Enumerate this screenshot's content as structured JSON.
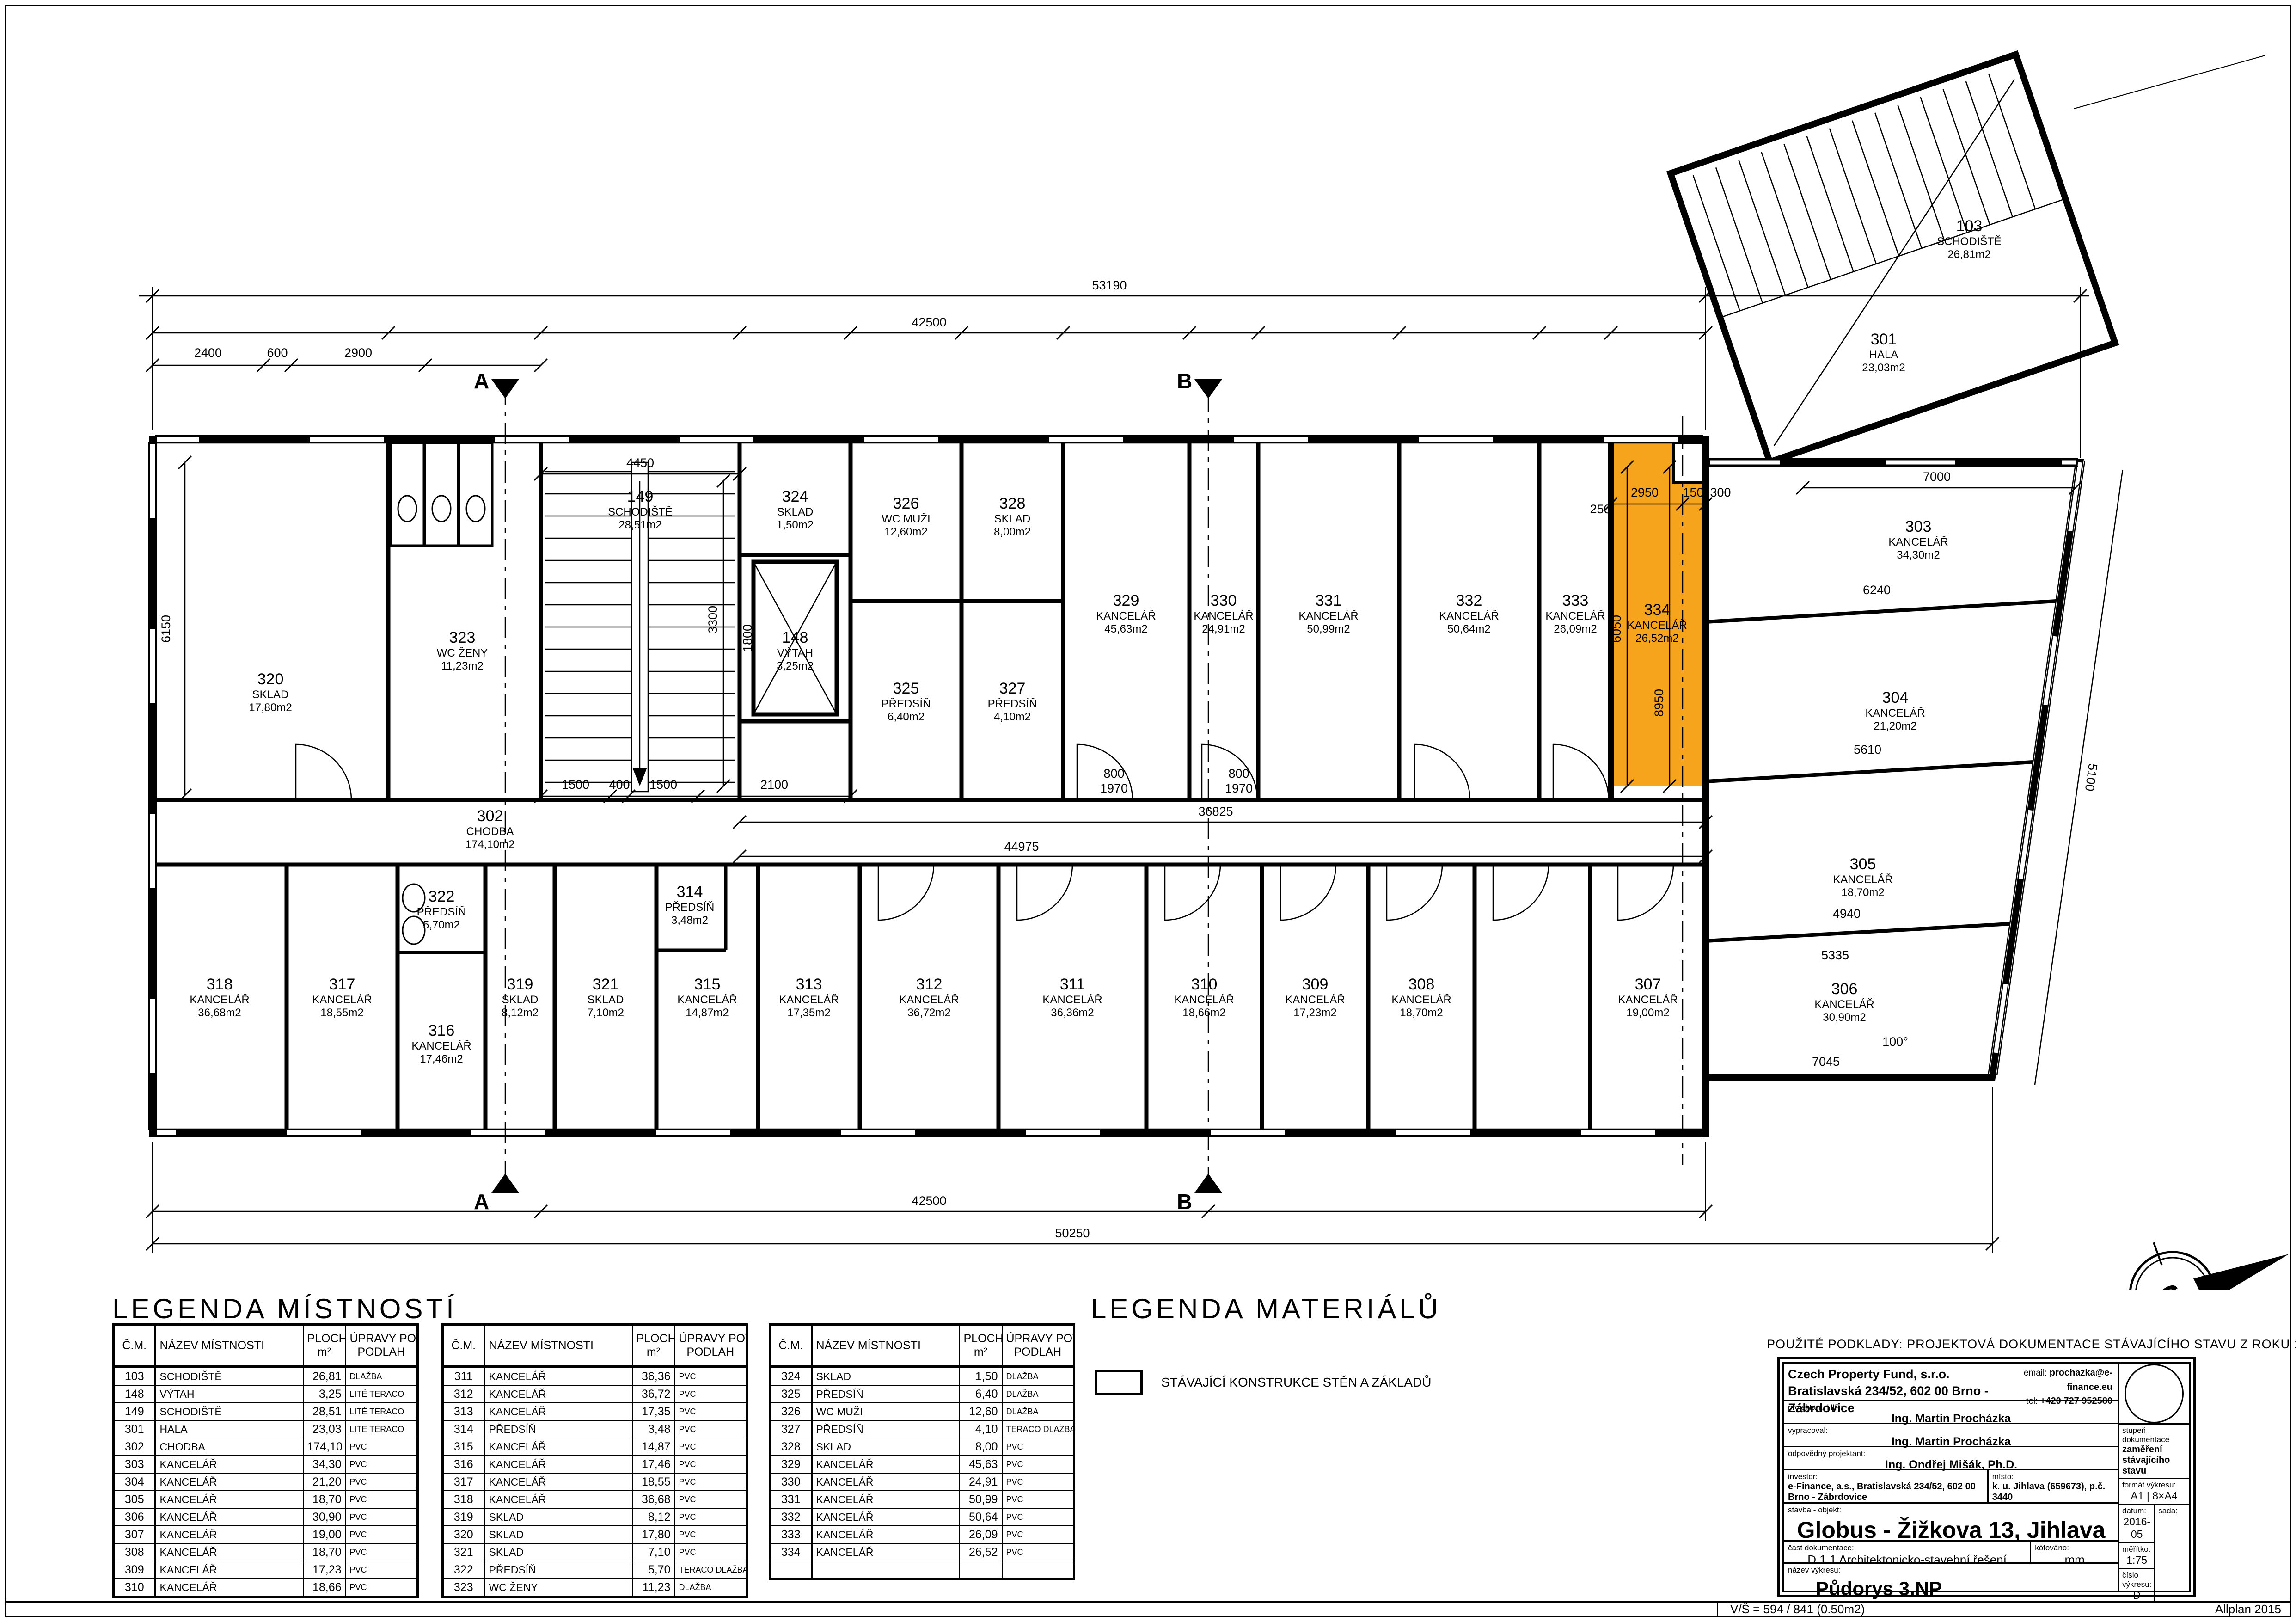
{
  "sheet": {
    "footer_left": "V/Š = 594 / 841 (0.50m2)",
    "footer_right": "Allplan 2015",
    "sources_note": "POUŽITÉ PODKLADY: PROJEKTOVÁ DOKUMENTACE STÁVAJÍCÍHO STAVU Z ROKU 1996/4."
  },
  "legend_rooms": {
    "title": "LEGENDA MÍSTNOSTÍ",
    "headers": {
      "num": "Č.M.",
      "name": "NÁZEV MÍSTNOSTI",
      "area1": "PLOCHA",
      "area2": "m²",
      "floor1": "ÚPRAVY POVRCHŮ",
      "floor2": "PODLAH"
    },
    "tables": [
      [
        {
          "n": "103",
          "t": "SCHODIŠTĚ",
          "a": "26,81",
          "f": "DLAŽBA"
        },
        {
          "n": "148",
          "t": "VÝTAH",
          "a": "3,25",
          "f": "LITÉ TERACO"
        },
        {
          "n": "149",
          "t": "SCHODIŠTĚ",
          "a": "28,51",
          "f": "LITÉ TERACO"
        },
        {
          "n": "301",
          "t": "HALA",
          "a": "23,03",
          "f": "LITÉ TERACO"
        },
        {
          "n": "302",
          "t": "CHODBA",
          "a": "174,10",
          "f": "PVC"
        },
        {
          "n": "303",
          "t": "KANCELÁŘ",
          "a": "34,30",
          "f": "PVC"
        },
        {
          "n": "304",
          "t": "KANCELÁŘ",
          "a": "21,20",
          "f": "PVC"
        },
        {
          "n": "305",
          "t": "KANCELÁŘ",
          "a": "18,70",
          "f": "PVC"
        },
        {
          "n": "306",
          "t": "KANCELÁŘ",
          "a": "30,90",
          "f": "PVC"
        },
        {
          "n": "307",
          "t": "KANCELÁŘ",
          "a": "19,00",
          "f": "PVC"
        },
        {
          "n": "308",
          "t": "KANCELÁŘ",
          "a": "18,70",
          "f": "PVC"
        },
        {
          "n": "309",
          "t": "KANCELÁŘ",
          "a": "17,23",
          "f": "PVC"
        },
        {
          "n": "310",
          "t": "KANCELÁŘ",
          "a": "18,66",
          "f": "PVC"
        }
      ],
      [
        {
          "n": "311",
          "t": "KANCELÁŘ",
          "a": "36,36",
          "f": "PVC"
        },
        {
          "n": "312",
          "t": "KANCELÁŘ",
          "a": "36,72",
          "f": "PVC"
        },
        {
          "n": "313",
          "t": "KANCELÁŘ",
          "a": "17,35",
          "f": "PVC"
        },
        {
          "n": "314",
          "t": "PŘEDSÍŇ",
          "a": "3,48",
          "f": "PVC"
        },
        {
          "n": "315",
          "t": "KANCELÁŘ",
          "a": "14,87",
          "f": "PVC"
        },
        {
          "n": "316",
          "t": "KANCELÁŘ",
          "a": "17,46",
          "f": "PVC"
        },
        {
          "n": "317",
          "t": "KANCELÁŘ",
          "a": "18,55",
          "f": "PVC"
        },
        {
          "n": "318",
          "t": "KANCELÁŘ",
          "a": "36,68",
          "f": "PVC"
        },
        {
          "n": "319",
          "t": "SKLAD",
          "a": "8,12",
          "f": "PVC"
        },
        {
          "n": "320",
          "t": "SKLAD",
          "a": "17,80",
          "f": "PVC"
        },
        {
          "n": "321",
          "t": "SKLAD",
          "a": "7,10",
          "f": "PVC"
        },
        {
          "n": "322",
          "t": "PŘEDSÍŇ",
          "a": "5,70",
          "f": "TERACO DLAŽBA"
        },
        {
          "n": "323",
          "t": "WC ŽENY",
          "a": "11,23",
          "f": "DLAŽBA"
        }
      ],
      [
        {
          "n": "324",
          "t": "SKLAD",
          "a": "1,50",
          "f": "DLAŽBA"
        },
        {
          "n": "325",
          "t": "PŘEDSÍŇ",
          "a": "6,40",
          "f": "DLAŽBA"
        },
        {
          "n": "326",
          "t": "WC MUŽI",
          "a": "12,60",
          "f": "DLAŽBA"
        },
        {
          "n": "327",
          "t": "PŘEDSÍŇ",
          "a": "4,10",
          "f": "TERACO DLAŽBA"
        },
        {
          "n": "328",
          "t": "SKLAD",
          "a": "8,00",
          "f": "PVC"
        },
        {
          "n": "329",
          "t": "KANCELÁŘ",
          "a": "45,63",
          "f": "PVC"
        },
        {
          "n": "330",
          "t": "KANCELÁŘ",
          "a": "24,91",
          "f": "PVC"
        },
        {
          "n": "331",
          "t": "KANCELÁŘ",
          "a": "50,99",
          "f": "PVC"
        },
        {
          "n": "332",
          "t": "KANCELÁŘ",
          "a": "50,64",
          "f": "PVC"
        },
        {
          "n": "333",
          "t": "KANCELÁŘ",
          "a": "26,09",
          "f": "PVC"
        },
        {
          "n": "334",
          "t": "KANCELÁŘ",
          "a": "26,52",
          "f": "PVC"
        },
        {
          "n": "",
          "t": "",
          "a": "",
          "f": ""
        }
      ]
    ]
  },
  "legend_materials": {
    "title": "LEGENDA MATERIÁLŮ",
    "items": [
      {
        "label": "STÁVAJÍCÍ KONSTRUKCE STĚN A ZÁKLADŮ"
      }
    ]
  },
  "title_block": {
    "company_name": "Czech Property Fund, s.r.o.",
    "company_address": "Bratislavská 234/52, 602 00 Brno - Zábrdovice",
    "email_label": "email:",
    "email": "prochazka@e-finance.eu",
    "tel_label": "tel:",
    "tel": "+420 727 952580",
    "projektant_label": "projektant, HIP:",
    "projektant": "Ing. Martin Procházka",
    "vypracoval_label": "vypracoval:",
    "vypracoval": "Ing. Martin Procházka",
    "odpovedny_label": "odpovědný projektant:",
    "odpovedny": "Ing. Ondřej Mišák, Ph.D.",
    "investor_label": "investor:",
    "investor": "e-Finance, a.s., Bratislavská 234/52, 602 00 Brno - Zábrdovice",
    "misto_label": "místo:",
    "misto": "k. u. Jihlava (659673), p.č. 3440",
    "stavba_label": "stavba - objekt:",
    "stavba": "Globus - Žižkova 13, Jihlava",
    "cast_label": "část dokumentace:",
    "cast": "D.1.1 Architektonicko-stavební řešení",
    "kotovano_label": "kótováno:",
    "kotovano": "mm",
    "nazev_label": "název výkresu:",
    "nazev": "Půdorys 3.NP",
    "stupen_label": "stupeň dokumentace",
    "stupen": "zaměření stávajícího stavu",
    "format_label": "formát výkresu:",
    "format": "A1 | 8×A4",
    "datum_label": "datum:",
    "datum": "2016-05",
    "sada_label": "sada:",
    "meritko_label": "měřítko:",
    "meritko": "1:75",
    "cislo_label": "číslo výkresu:",
    "cislo": "D 1.1.4"
  },
  "plan": {
    "highlight_color": "#F6A41C",
    "compass_letter": "S",
    "section_marks": [
      "A",
      "B"
    ],
    "rooms": [
      {
        "id": "320",
        "name": "SKLAD",
        "area": "17,80m2"
      },
      {
        "id": "323",
        "name": "WC ŽENY",
        "area": "11,23m2"
      },
      {
        "id": "149",
        "name": "SCHODIŠTĚ",
        "area": "28,51m2"
      },
      {
        "id": "324",
        "name": "SKLAD",
        "area": "1,50m2"
      },
      {
        "id": "148",
        "name": "VÝTAH",
        "area": "3,25m2"
      },
      {
        "id": "326",
        "name": "WC MUŽI",
        "area": "12,60m2"
      },
      {
        "id": "325",
        "name": "PŘEDSÍŇ",
        "area": "6,40m2"
      },
      {
        "id": "328",
        "name": "SKLAD",
        "area": "8,00m2"
      },
      {
        "id": "327",
        "name": "PŘEDSÍŇ",
        "area": "4,10m2"
      },
      {
        "id": "329",
        "name": "KANCELÁŘ",
        "area": "45,63m2"
      },
      {
        "id": "330",
        "name": "KANCELÁŘ",
        "area": "24,91m2"
      },
      {
        "id": "331",
        "name": "KANCELÁŘ",
        "area": "50,99m2"
      },
      {
        "id": "332",
        "name": "KANCELÁŘ",
        "area": "50,64m2"
      },
      {
        "id": "333",
        "name": "KANCELÁŘ",
        "area": "26,09m2"
      },
      {
        "id": "334",
        "name": "KANCELÁŘ",
        "area": "26,52m2"
      },
      {
        "id": "302",
        "name": "CHODBA",
        "area": "174,10m2"
      },
      {
        "id": "322",
        "name": "PŘEDSÍŇ",
        "area": "5,70m2"
      },
      {
        "id": "318",
        "name": "KANCELÁŘ",
        "area": "36,68m2"
      },
      {
        "id": "317",
        "name": "KANCELÁŘ",
        "area": "18,55m2"
      },
      {
        "id": "316",
        "name": "KANCELÁŘ",
        "area": "17,46m2"
      },
      {
        "id": "319",
        "name": "SKLAD",
        "area": "8,12m2"
      },
      {
        "id": "321",
        "name": "SKLAD",
        "area": "7,10m2"
      },
      {
        "id": "314",
        "name": "PŘEDSÍŇ",
        "area": "3,48m2"
      },
      {
        "id": "315",
        "name": "KANCELÁŘ",
        "area": "14,87m2"
      },
      {
        "id": "313",
        "name": "KANCELÁŘ",
        "area": "17,35m2"
      },
      {
        "id": "312",
        "name": "KANCELÁŘ",
        "area": "36,72m2"
      },
      {
        "id": "311",
        "name": "KANCELÁŘ",
        "area": "36,36m2"
      },
      {
        "id": "310",
        "name": "KANCELÁŘ",
        "area": "18,66m2"
      },
      {
        "id": "309",
        "name": "KANCELÁŘ",
        "area": "17,23m2"
      },
      {
        "id": "308",
        "name": "KANCELÁŘ",
        "area": "18,70m2"
      },
      {
        "id": "307",
        "name": "KANCELÁŘ",
        "area": "19,00m2"
      },
      {
        "id": "306",
        "name": "KANCELÁŘ",
        "area": "30,90m2"
      },
      {
        "id": "303",
        "name": "KANCELÁŘ",
        "area": "34,30m2"
      },
      {
        "id": "304",
        "name": "KANCELÁŘ",
        "area": "21,20m2"
      },
      {
        "id": "305",
        "name": "KANCELÁŘ",
        "area": "18,70m2"
      },
      {
        "id": "103",
        "name": "SCHODIŠTĚ",
        "area": "26,81m2"
      },
      {
        "id": "301",
        "name": "HALA",
        "area": "23,03m2"
      }
    ],
    "dims": [
      "53190",
      "42500",
      "42500",
      "50250",
      "36825",
      "44975",
      "6150",
      "7000",
      "6240",
      "5610",
      "4940",
      "5335",
      "7045",
      "100°",
      "5100",
      "2950",
      "150",
      "300",
      "250",
      "6050",
      "8950",
      "4450",
      "3300",
      "1800",
      "1500",
      "400",
      "1500",
      "2100",
      "800",
      "1970",
      "800",
      "1970",
      "2400",
      "600",
      "2900"
    ]
  }
}
